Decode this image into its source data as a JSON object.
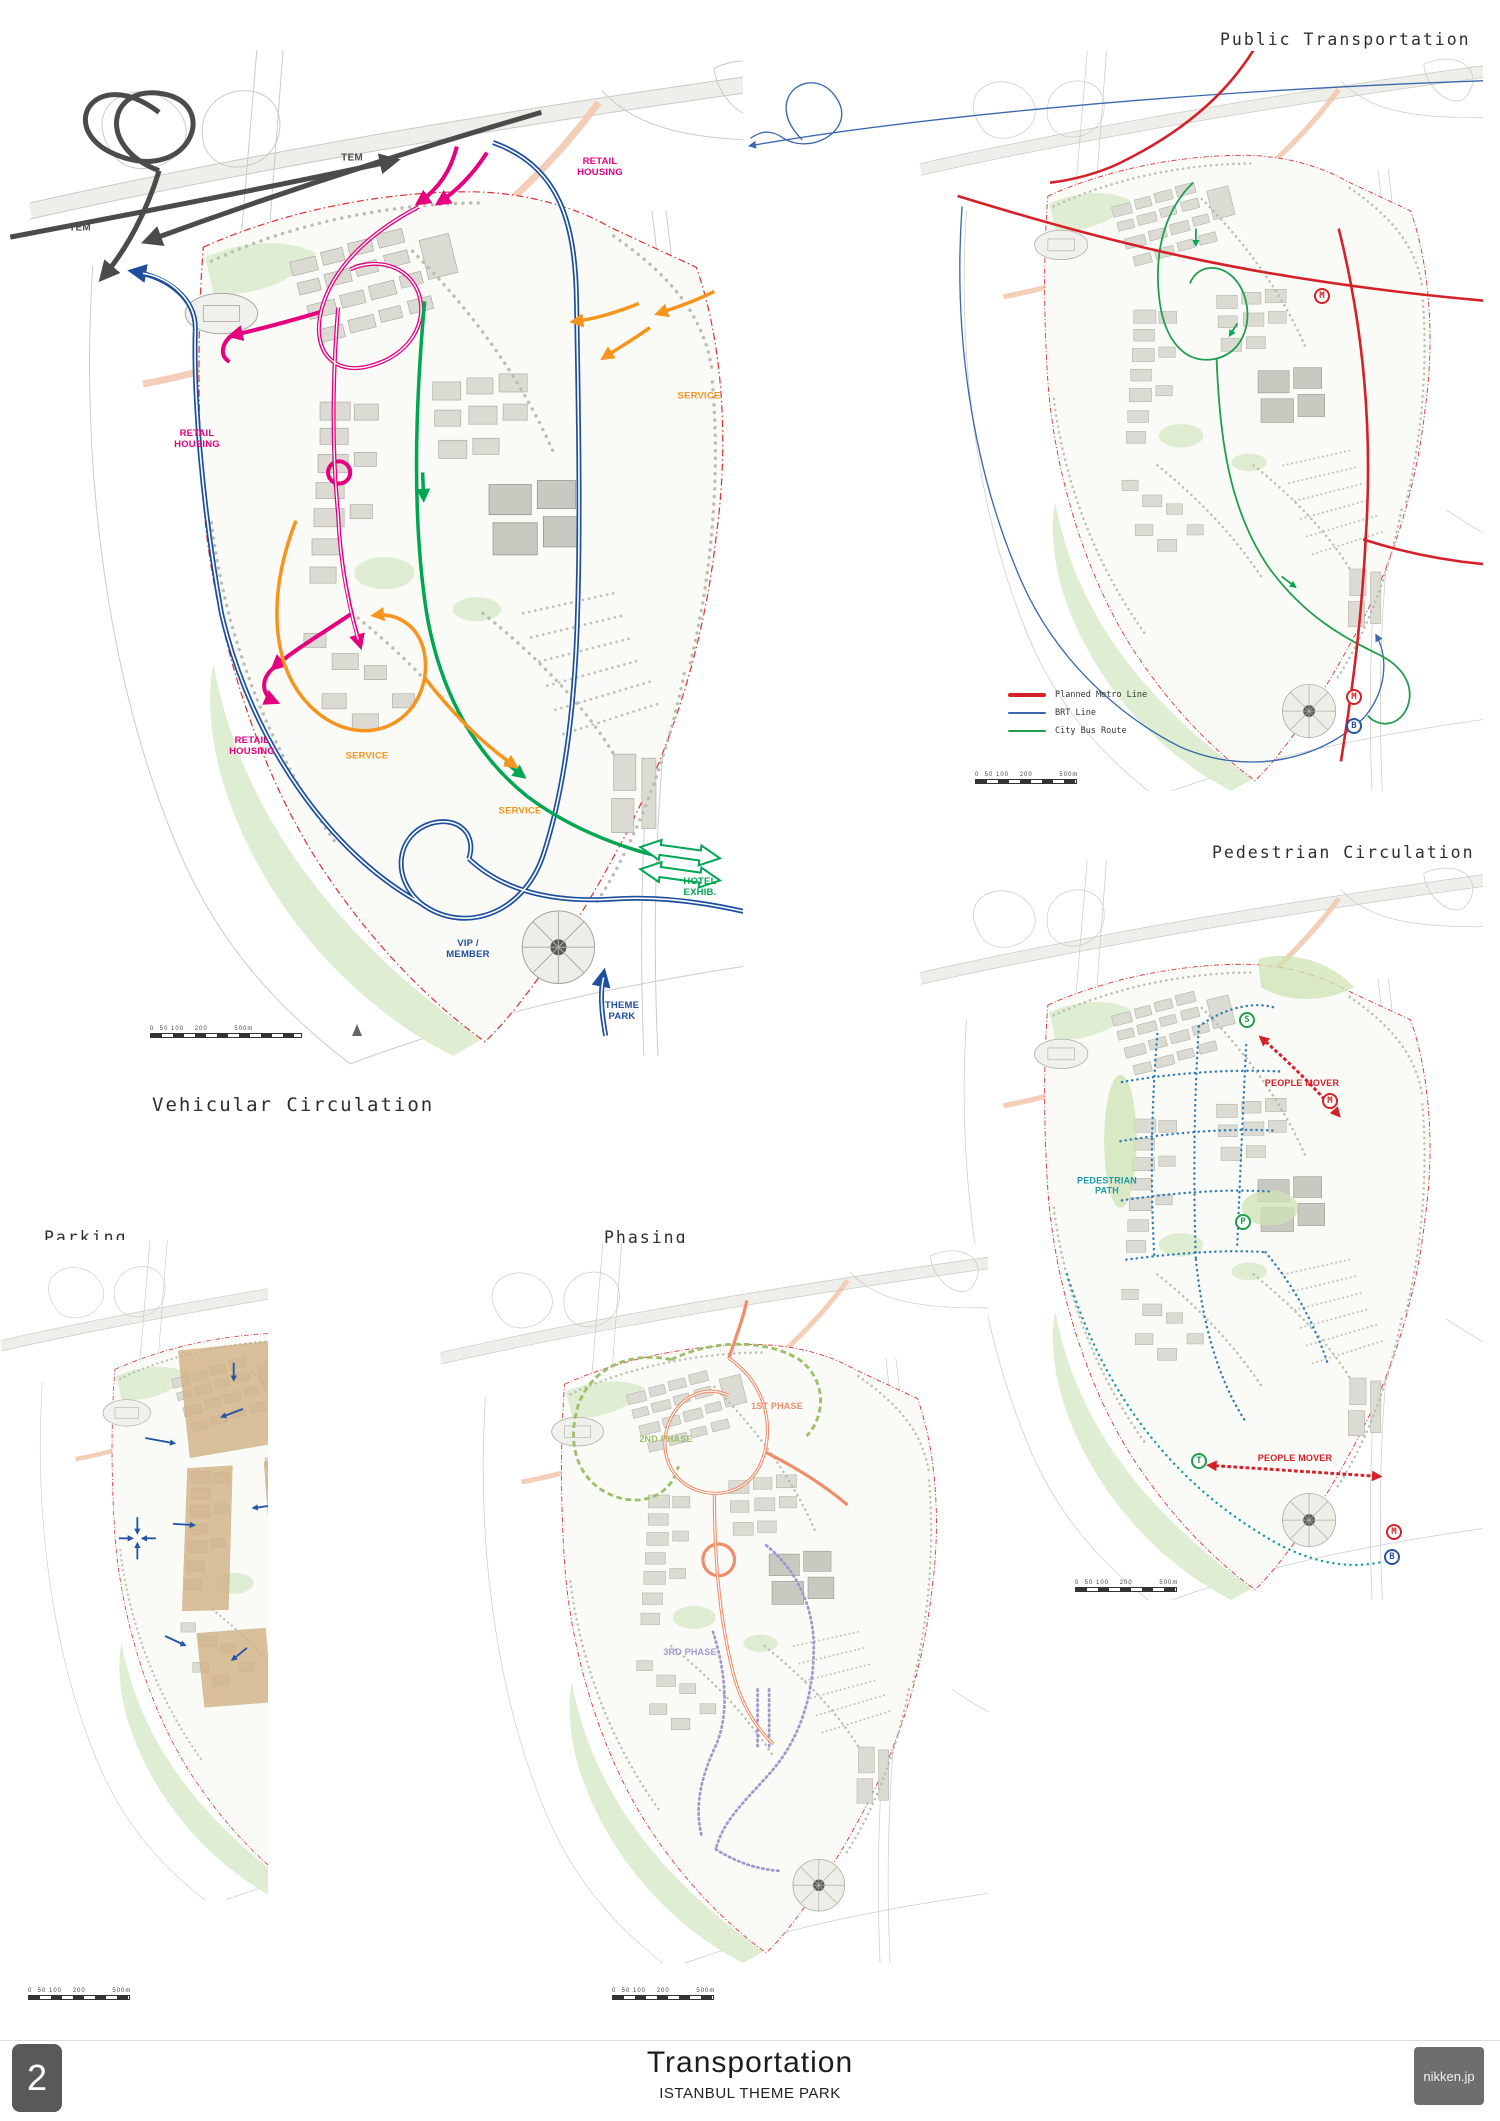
{
  "page": {
    "number": "2",
    "title": "Transportation",
    "subtitle": "ISTANBUL THEME PARK",
    "brand": "nikken.jp"
  },
  "colors": {
    "retail_magenta": "#e6007e",
    "ring_road_blue": "#1d4f9e",
    "service_orange": "#f7941d",
    "hotel_green": "#00a651",
    "tem_gray": "#4b4b4b",
    "metro_red": "#d62027",
    "brt_blue": "#3a67ae",
    "city_bus_green": "#1f9d4d",
    "pedestrian_blue": "#2f7cb5",
    "pedestrian_teal": "#1a9aa8",
    "parking_tan": "#d2b285",
    "parking_arrow_blue": "#2456a5",
    "phase1_salmon": "#ef8e6c",
    "phase2_green": "#9ebf6a",
    "phase3_purple": "#a396cd",
    "site_boundary_red": "#dd3333"
  },
  "scale_bar": {
    "ticks": "0  50 100    200          500m"
  },
  "panels": {
    "vehicular": {
      "title": "Vehicular Circulation",
      "labels": {
        "tem_a": "TEM",
        "tem_b": "TEM",
        "retail_top": "RETAIL\nHOUSING",
        "retail_left": "RETAIL\nHOUSING",
        "retail_lower": "RETAIL\nHOUSING",
        "service_right": "SERVICE",
        "service_mid": "SERVICE",
        "service_low": "SERVICE",
        "hotel": "HOTEL\nEXHIB.",
        "vip": "VIP /\nMEMBER",
        "theme_park": "THEME\nPARK"
      }
    },
    "public_transport": {
      "title": "Public Transportation",
      "legend": [
        {
          "label": "Planned Metro Line"
        },
        {
          "label": "BRT Line"
        },
        {
          "label": "City Bus Route"
        }
      ],
      "badges": [
        {
          "letter": "M"
        },
        {
          "letter": "M"
        },
        {
          "letter": "B"
        }
      ]
    },
    "pedestrian": {
      "title": "Pedestrian Circulation",
      "labels": {
        "people_mover_top": "PEOPLE MOVER",
        "people_mover_bottom": "PEOPLE MOVER",
        "pedestrian_path": "PEDESTRIAN\nPATH"
      },
      "badges": [
        {
          "letter": "S"
        },
        {
          "letter": "M"
        },
        {
          "letter": "P"
        },
        {
          "letter": "T"
        },
        {
          "letter": "M"
        },
        {
          "letter": "B"
        }
      ]
    },
    "parking": {
      "title": "Parking"
    },
    "phasing": {
      "title": "Phasing",
      "labels": {
        "phase1": "1ST PHASE",
        "phase2": "2ND PHASE",
        "phase3": "3RD PHASE"
      }
    }
  }
}
